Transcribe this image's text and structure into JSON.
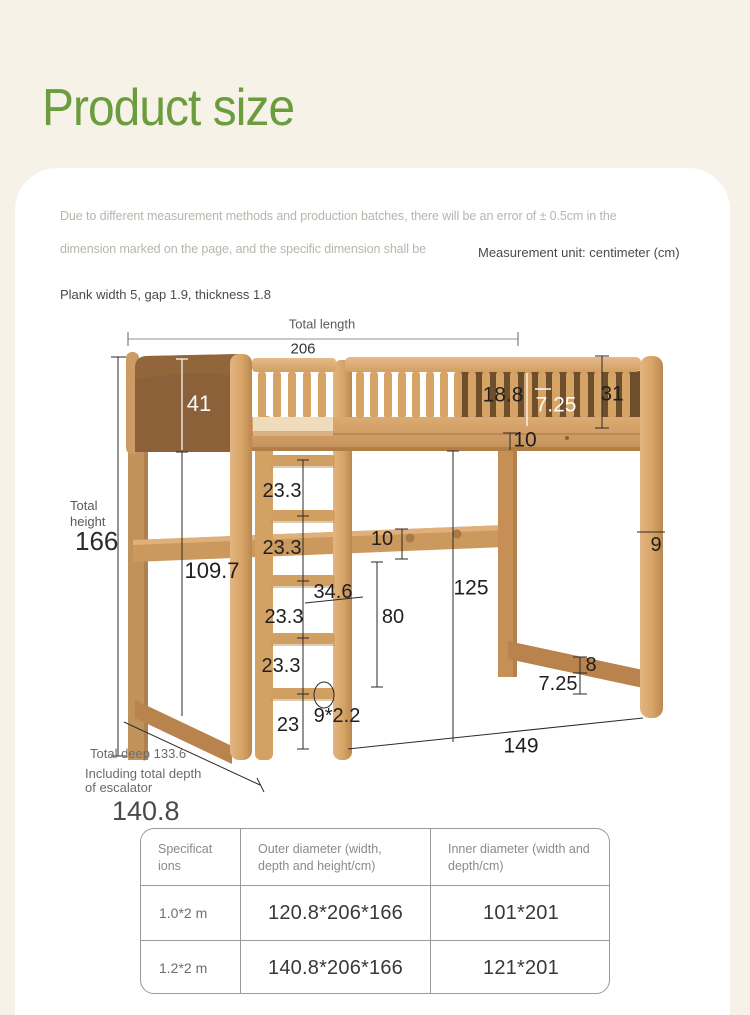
{
  "page_title": "Product size",
  "note": {
    "line1": "Due to different measurement methods and production batches, there will be an error of ± 0.5cm in the",
    "line2": "dimension marked on the page, and the specific dimension shall be",
    "measurement_unit": "Measurement unit: centimeter (cm)",
    "plank_note": "Plank width 5, gap 1.9, thickness 1.8"
  },
  "diagram": {
    "total_length_label": "Total length",
    "total_length": "206",
    "headboard_height": "41",
    "slat_gap": "18.8",
    "slat_pitch": "7.25",
    "guardrail_height": "31",
    "frame_thickness": "10",
    "total_height_word1": "Total",
    "total_height_word2": "height",
    "total_height": "166",
    "ladder_gap_1": "23.3",
    "ladder_gap_2": "23.3",
    "ladder_gap_3": "23.3",
    "ladder_gap_4": "23.3",
    "under_frame_height": "109.7",
    "ladder_width": "34.6",
    "bottom_gap": "23",
    "rung_section": "9*2.2",
    "hook_rail_height": "10",
    "rail_floor_gap": "80",
    "clearance_height": "125",
    "post_width": "9",
    "foot_rail_height": "8",
    "foot_rail_gap": "7.25",
    "inner_length": "149",
    "total_deep_label": "Total deep 133.6",
    "escalator_line1": "Including total depth",
    "escalator_line2": "of escalator",
    "total_depth": "140.8"
  },
  "table": {
    "headers": [
      "Specifications",
      "Outer diameter (width, depth and height/cm)",
      "Inner diameter (width and depth/cm)"
    ],
    "rows": [
      [
        "1.0*2 m",
        "120.8*206*166",
        "101*201"
      ],
      [
        "1.2*2 m",
        "140.8*206*166",
        "121*201"
      ]
    ]
  },
  "colors": {
    "background": "#f6f2e8",
    "card": "#ffffff",
    "accent_green": "#6b9c3e",
    "wood_light": "#dfae76",
    "wood_dark_panel": "#8c6139"
  }
}
